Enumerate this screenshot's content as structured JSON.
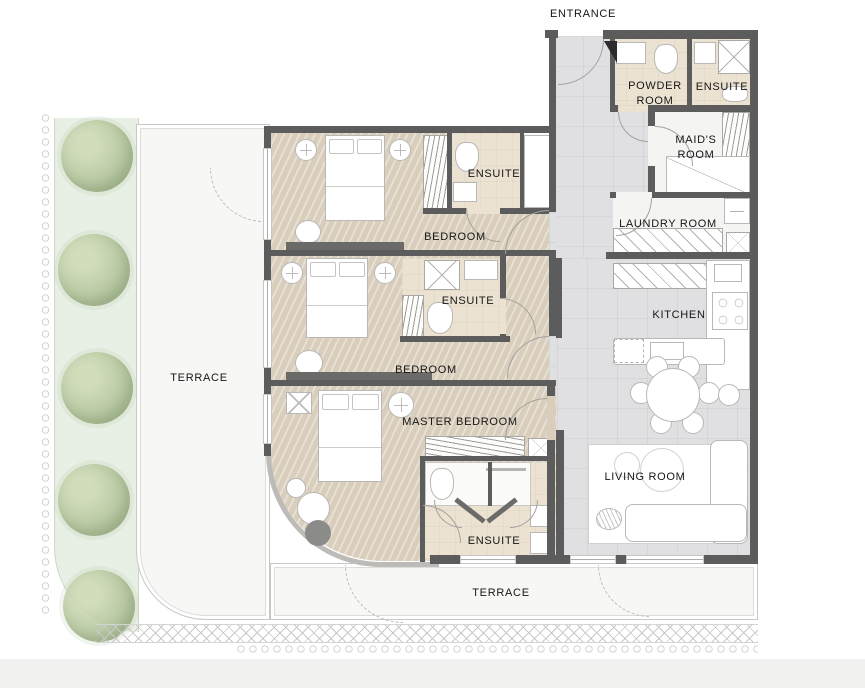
{
  "palette": {
    "wall": "#5c5c5c",
    "wood": "#d9cdbb",
    "bath": "#ece2d2",
    "tile": "#e0e0e2",
    "utility": "#f4f4f3",
    "terrace": "#f7f7f6",
    "garden": "#e8efe4",
    "tree": "#b9caa0",
    "label": "#161616",
    "outline": "#b9b8b5"
  },
  "rooms": {
    "entrance": {
      "label": "ENTRANCE"
    },
    "powder": {
      "label": "POWDER ROOM"
    },
    "ensuite_top": {
      "label": "ENSUITE"
    },
    "maids": {
      "label": "MAID'S ROOM"
    },
    "laundry": {
      "label": "LAUNDRY ROOM"
    },
    "kitchen": {
      "label": "KITCHEN"
    },
    "living": {
      "label": "LIVING ROOM"
    },
    "bedroom_1": {
      "label": "BEDROOM"
    },
    "ensuite_1": {
      "label": "ENSUITE"
    },
    "bedroom_2": {
      "label": "BEDROOM"
    },
    "ensuite_2": {
      "label": "ENSUITE"
    },
    "master": {
      "label": "MASTER BEDROOM"
    },
    "ensuite_master": {
      "label": "ENSUITE"
    },
    "terrace_left": {
      "label": "TERRACE"
    },
    "terrace_bottom": {
      "label": "TERRACE"
    }
  },
  "icons": [
    "tree-icon",
    "bed-icon",
    "nightstand-icon",
    "wardrobe-icon",
    "shower-icon",
    "toilet-icon",
    "sink-icon",
    "washer-icon",
    "stove-icon",
    "dining-table-icon",
    "chair-icon",
    "sofa-icon",
    "coffee-table-icon",
    "plant-icon",
    "door-arc-icon",
    "window-icon"
  ]
}
